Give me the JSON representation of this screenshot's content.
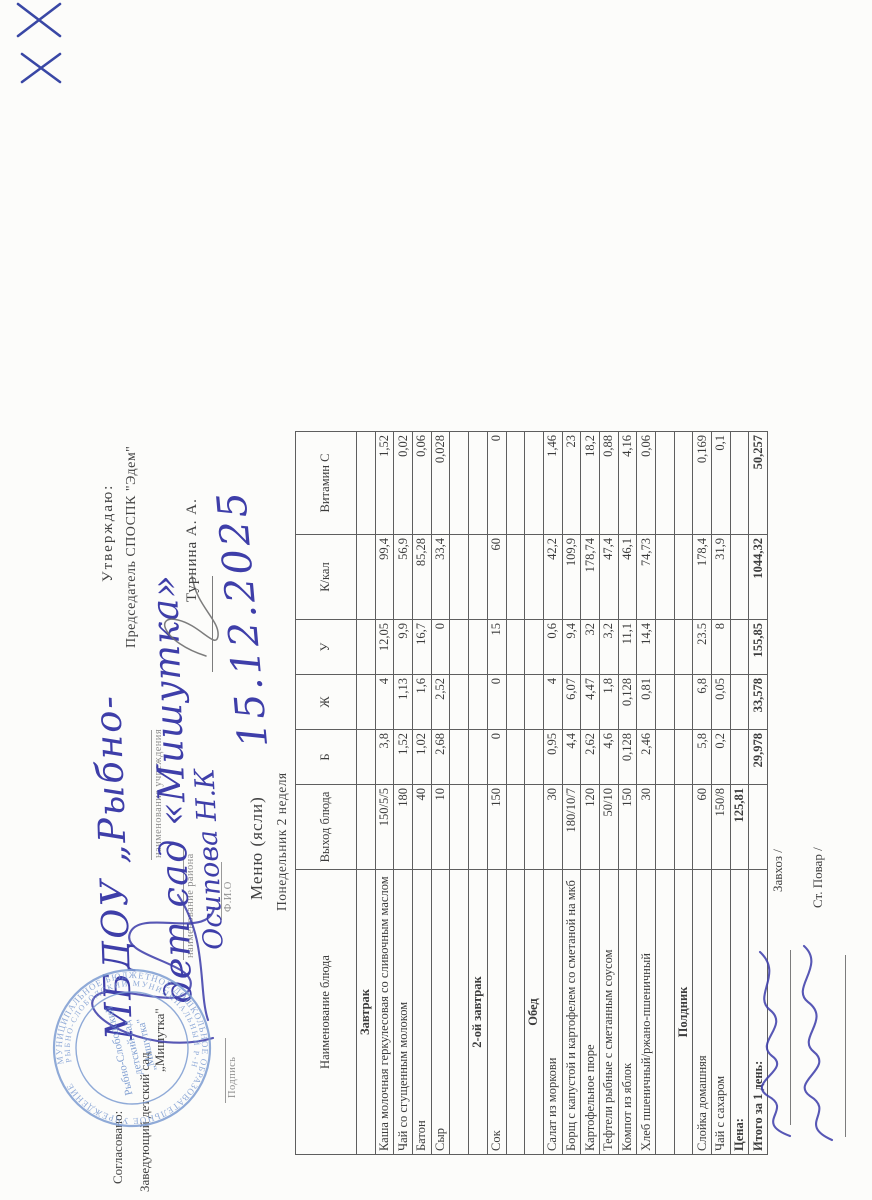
{
  "approval_right": {
    "label": "Утверждаю:",
    "title": "Председатель СПОСПК \"Эдем\"",
    "name": "Турнина А. А."
  },
  "approval_left": {
    "agreed": "Согласовано:",
    "position_line": "Заведующий детский сад",
    "org_quoted": "„Мишутка\"",
    "hw_org_1": "МБДОУ „Рыбно-",
    "hw_org_2": "дет сад «Мишутка»",
    "hw_fio": "Осипова Н.К",
    "cap_institution": "наименование учреждения",
    "cap_district": "наименование района",
    "cap_fio": "Ф.И.О",
    "cap_sign": "Подпись"
  },
  "stamp": {
    "ring_outer": "МУНИЦИПАЛЬНОЕ БЮДЖЕТНОЕ ДОШКОЛЬНОЕ ОБРАЗОВАТЕЛЬНОЕ УЧРЕЖДЕНИЕ",
    "ring_inner": "РЫБНО-СЛОБОДСКИЙ МУНИЦИПАЛЬНЫЙ Р-Н",
    "center_1": "Рыбно-Слободский",
    "center_2": "детский сад",
    "center_3": "„Мишутка\""
  },
  "menu_header": {
    "title": "Меню  (ясли)",
    "subtitle": "Понедельник 2 неделя",
    "hw_date": "15.12.2025"
  },
  "table": {
    "columns": [
      "Наименование блюда",
      "Выход блюда",
      "Б",
      "Ж",
      "У",
      "К/кал",
      "Витамин С"
    ],
    "rows": [
      {
        "type": "section",
        "name": "Завтрак",
        "out": "",
        "b": "",
        "zh": "",
        "u": "",
        "kcal": "",
        "vitc": ""
      },
      {
        "type": "dish",
        "name": "Каша молочная геркулесовая со сливочным маслом",
        "out": "150/5/5",
        "b": "3,8",
        "zh": "4",
        "u": "12,05",
        "kcal": "99,4",
        "vitc": "1,52"
      },
      {
        "type": "dish",
        "name": "Чай со сгущенным молоком",
        "out": "180",
        "b": "1,52",
        "zh": "1,13",
        "u": "9,9",
        "kcal": "56,9",
        "vitc": "0,02"
      },
      {
        "type": "dish",
        "name": "Батон",
        "out": "40",
        "b": "1,02",
        "zh": "1,6",
        "u": "16,7",
        "kcal": "85,28",
        "vitc": "0,06"
      },
      {
        "type": "dish",
        "name": "Сыр",
        "out": "10",
        "b": "2,68",
        "zh": "2,52",
        "u": "0",
        "kcal": "33,4",
        "vitc": "0,028"
      },
      {
        "type": "empty",
        "name": "",
        "out": "",
        "b": "",
        "zh": "",
        "u": "",
        "kcal": "",
        "vitc": ""
      },
      {
        "type": "section",
        "name": "2-ой завтрак",
        "out": "",
        "b": "",
        "zh": "",
        "u": "",
        "kcal": "",
        "vitc": ""
      },
      {
        "type": "dish",
        "name": "Сок",
        "out": "150",
        "b": "0",
        "zh": "0",
        "u": "15",
        "kcal": "60",
        "vitc": "0"
      },
      {
        "type": "empty",
        "name": "",
        "out": "",
        "b": "",
        "zh": "",
        "u": "",
        "kcal": "",
        "vitc": ""
      },
      {
        "type": "section",
        "name": "Обед",
        "out": "",
        "b": "",
        "zh": "",
        "u": "",
        "kcal": "",
        "vitc": ""
      },
      {
        "type": "dish",
        "name": "Салат из моркови",
        "out": "30",
        "b": "0,95",
        "zh": "4",
        "u": "0,6",
        "kcal": "42,2",
        "vitc": "1,46"
      },
      {
        "type": "dish",
        "name": "Борщ с капустой и картофелем со сметаной на мкб",
        "out": "180/10/7",
        "b": "4,4",
        "zh": "6,07",
        "u": "9,4",
        "kcal": "109,9",
        "vitc": "23"
      },
      {
        "type": "dish",
        "name": "Картофельное пюре",
        "out": "120",
        "b": "2,62",
        "zh": "4,47",
        "u": "32",
        "kcal": "178,74",
        "vitc": "18,2"
      },
      {
        "type": "dish",
        "name": "Тефтели рыбные с сметанным соусом",
        "out": "50/10",
        "b": "4,6",
        "zh": "1,8",
        "u": "3,2",
        "kcal": "47,4",
        "vitc": "0,88"
      },
      {
        "type": "dish",
        "name": "Компот из яблок",
        "out": "150",
        "b": "0,128",
        "zh": "0,128",
        "u": "11,1",
        "kcal": "46,1",
        "vitc": "4,16"
      },
      {
        "type": "dish",
        "name": "Хлеб пшеничный/ржано-пшеничный",
        "out": "30",
        "b": "2,46",
        "zh": "0,81",
        "u": "14,4",
        "kcal": "74,73",
        "vitc": "0,06"
      },
      {
        "type": "empty",
        "name": "",
        "out": "",
        "b": "",
        "zh": "",
        "u": "",
        "kcal": "",
        "vitc": ""
      },
      {
        "type": "section",
        "name": "Полдник",
        "out": "",
        "b": "",
        "zh": "",
        "u": "",
        "kcal": "",
        "vitc": ""
      },
      {
        "type": "dish",
        "name": "Слойка домашняя",
        "out": "60",
        "b": "5,8",
        "zh": "6,8",
        "u": "23.5",
        "kcal": "178,4",
        "vitc": "0,169"
      },
      {
        "type": "dish",
        "name": "Чай с сахаром",
        "out": "150/8",
        "b": "0,2",
        "zh": "0,05",
        "u": "8",
        "kcal": "31,9",
        "vitc": "0,1"
      },
      {
        "type": "total",
        "name": "Цена:",
        "out": "125,81",
        "b": "",
        "zh": "",
        "u": "",
        "kcal": "",
        "vitc": ""
      },
      {
        "type": "total",
        "name": "Итого за 1 день:",
        "out": "",
        "b": "29,978",
        "zh": "33,578",
        "u": "155,85",
        "kcal": "1044,32",
        "vitc": "50,257"
      }
    ]
  },
  "footer": {
    "zavhoz": "Завхоз /",
    "cook": "Ст. Повар /"
  }
}
